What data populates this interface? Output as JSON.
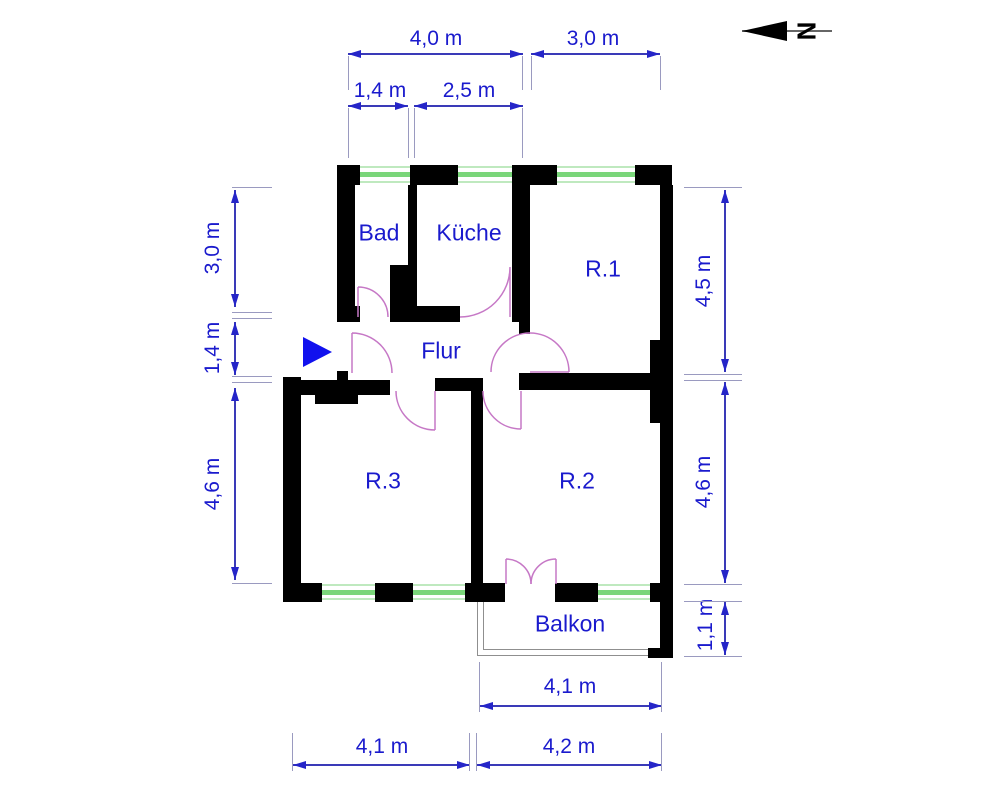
{
  "compass": {
    "label": "N"
  },
  "rooms": {
    "bad": "Bad",
    "kueche": "Küche",
    "r1": "R.1",
    "flur": "Flur",
    "r3": "R.3",
    "r2": "R.2",
    "balkon": "Balkon"
  },
  "dimensions": {
    "top": {
      "width_left": "4,0 m",
      "width_right": "3,0 m",
      "sub_left": "1,4 m",
      "sub_right": "2,5 m"
    },
    "left": {
      "upper": "3,0 m",
      "middle": "1,4 m",
      "lower": "4,6 m"
    },
    "right": {
      "upper": "4,5 m",
      "middle": "4,6 m",
      "lower": "1,1 m"
    },
    "bottom": {
      "balcony": "4,1 m",
      "left": "4,1 m",
      "right": "4,2 m"
    }
  },
  "colors": {
    "wall": "#000000",
    "dimension_text": "#1a1acd",
    "dimension_line": "#3a3ab8",
    "extension_line": "#9a9ac0",
    "window_green": "#7ad67a",
    "door_arc": "#c678c6",
    "entrance_arrow": "#1111ee",
    "background": "#ffffff"
  }
}
